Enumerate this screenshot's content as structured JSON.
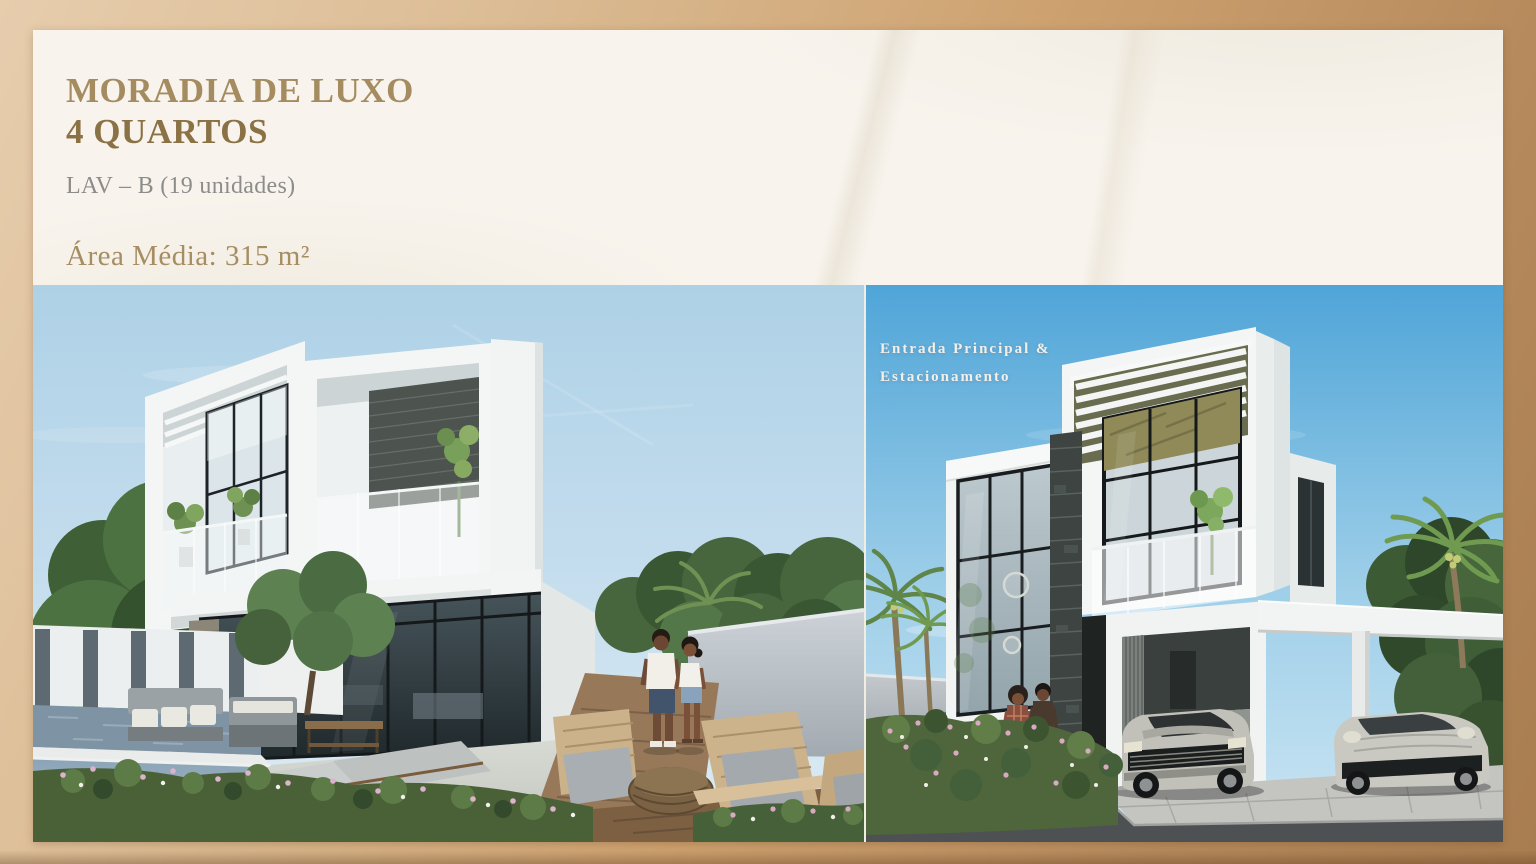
{
  "slide": {
    "header": {
      "title_line1": "MORADIA DE LUXO",
      "title_line2": "4 QUARTOS",
      "subtitle": "LAV – B (19 unidades)",
      "area": "Área Média: 315 m²"
    },
    "render_right": {
      "caption_line1": "Entrada Principal &",
      "caption_line2": "Estacionamento"
    },
    "palette": {
      "frame_gold_light": "#e7cdad",
      "frame_gold_dark": "#a87d50",
      "header_cream": "#f8f4ed",
      "title_bronze": "#a58c60",
      "title_dark_bronze": "#8a7244",
      "subtitle_gray": "#8c8c8a",
      "area_bronze": "#a68d62",
      "caption_white": "#f2efe9",
      "sky_left": "#aed1e6",
      "sky_right": "#4fa5d8"
    }
  }
}
